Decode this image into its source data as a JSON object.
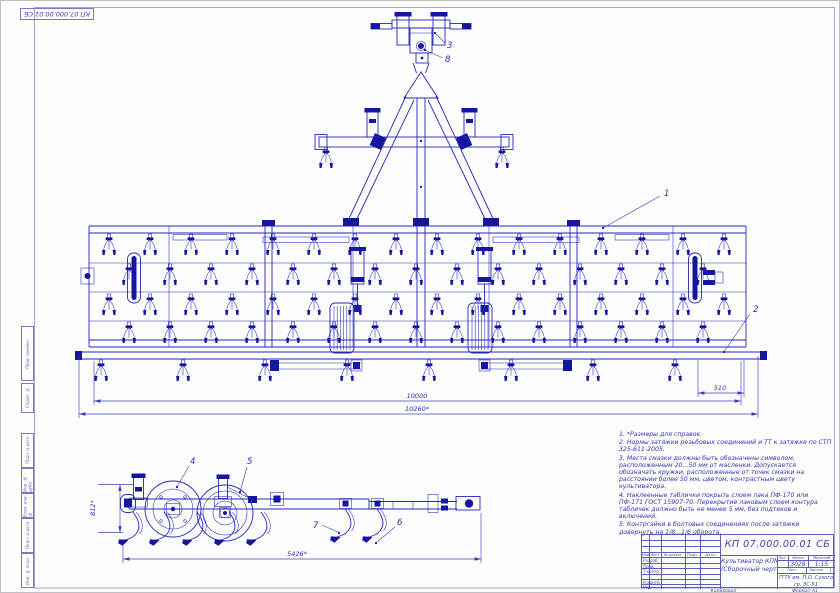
{
  "corner_stamp": {
    "designation": "КП 07.000.00.01 СБ"
  },
  "margin_stamps": {
    "perv": "Перв. примен.",
    "sprav": "Справ. №",
    "podp1": "Подп. и дата",
    "inv_dubl": "Инв. № дубл.",
    "vzam": "Взам. инв. №",
    "podp2": "Подп. и дата",
    "inv_podl": "Инв. № подл."
  },
  "callouts": {
    "c1": "1",
    "c2": "2",
    "c3": "3",
    "c4": "4",
    "c5": "5",
    "c6": "6",
    "c7": "7",
    "c8": "8"
  },
  "dimensions": {
    "inner_width": "10000",
    "overall_width": "10260*",
    "right_offset": "510",
    "side_length": "5426*",
    "side_height": "812*"
  },
  "notes": [
    "1. *Размеры для справок.",
    "2. Нормы затяжки резьбовых соединений и ТТ к затяжке по СТП 325-611-2005.",
    "3. Места смазки должны быть обозначены символом, расположенным 20...50 мм от масленки. Допускается обозначать кружки, расположенные от точек смазки на расстоянии более 50 мм, цветом, контрастным цвету культиватора.",
    "4. Наклеенные таблички покрыть слоем лака ПФ-170 или ПФ-171 ГОСТ 15907-70. Перекрытие лаковым слоем контура табличек должно быть не менее 5 мм, без подтеков и включений.",
    "5. Контргайки в болтовых соединениях после затяжки довернуть на 1/8...1/6 оборота."
  ],
  "title_block": {
    "designation": "КП 07.000.00.01 СБ",
    "name_line1": "Культиватор КПМ-10",
    "name_line2": "(Сборочный чертеж)",
    "mass": "3028",
    "scale": "1:15",
    "sheets_value": "1",
    "org_line1": "ГГТУ им. П.О. Сухого",
    "org_line2": "гр. ЗС-51",
    "labels": {
      "izm": "Изм.",
      "list": "Лист",
      "doc": "№ докум.",
      "podp": "Подп.",
      "date": "Дата",
      "razrab": "Разраб.",
      "prov": "Пров.",
      "tkontr": "Т.контр.",
      "nkontr": "Н.контр.",
      "utv": "Утв.",
      "lit": "Лит.",
      "mass": "Масса",
      "scale": "Масштаб",
      "sheet": "Лист",
      "sheets": "Листов",
      "kopiroval": "Копировал",
      "format": "Формат A1"
    }
  }
}
